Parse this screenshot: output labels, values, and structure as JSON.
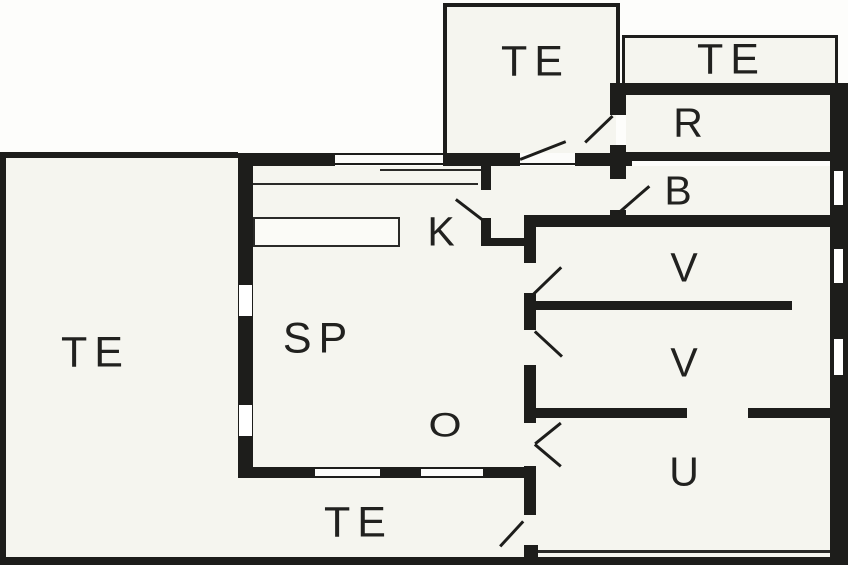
{
  "plan": {
    "title": "apartment-floor-plan",
    "wall_color": "#1d1d1b",
    "room_fill": "#f5f5ef",
    "outside_fill": "#fdfdfb",
    "rooms": [
      {
        "id": "te-left",
        "label": "TE"
      },
      {
        "id": "te-top",
        "label": "TE"
      },
      {
        "id": "te-right",
        "label": "TE"
      },
      {
        "id": "r",
        "label": "R"
      },
      {
        "id": "b",
        "label": "B"
      },
      {
        "id": "v1",
        "label": "V"
      },
      {
        "id": "v2",
        "label": "V"
      },
      {
        "id": "u",
        "label": "U"
      },
      {
        "id": "k",
        "label": "K"
      },
      {
        "id": "sp",
        "label": "SP"
      },
      {
        "id": "o",
        "label": "O"
      },
      {
        "id": "te-bottom",
        "label": "TE"
      }
    ]
  }
}
